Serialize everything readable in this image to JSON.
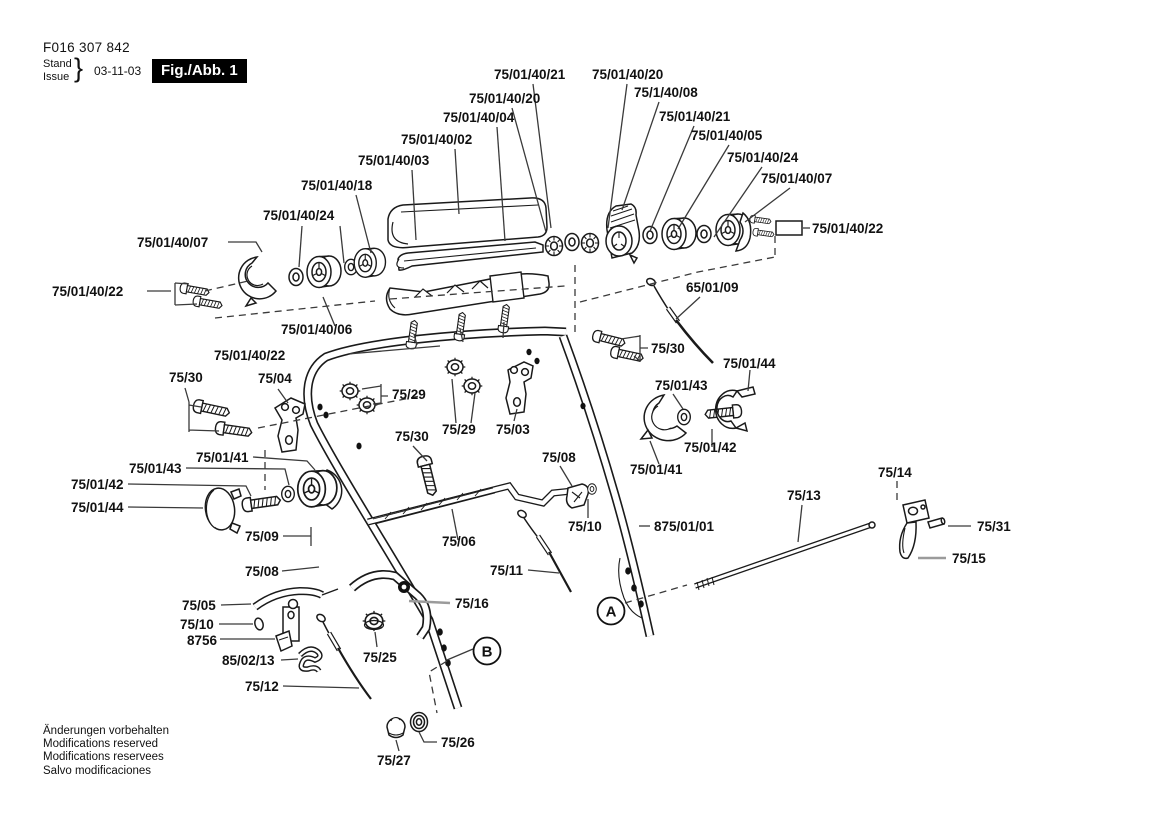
{
  "header": {
    "doc_number": "F016 307 842",
    "stand_label": "Stand",
    "issue_label": "Issue",
    "brace": "}",
    "date": "03-11-03",
    "figure_badge": "Fig./Abb. 1"
  },
  "footer": {
    "line1": "Änderungen vorbehalten",
    "line2": "Modifications reserved",
    "line3": "Modifications reservees",
    "line4": "Salvo modificaciones"
  },
  "diagram": {
    "callouts": {
      "a": "A",
      "b": "B"
    },
    "labels": [
      {
        "text": "75/01/40/21",
        "x": 494,
        "y": 79
      },
      {
        "text": "75/01/40/20",
        "x": 592,
        "y": 79
      },
      {
        "text": "75/01/40/20",
        "x": 469,
        "y": 103
      },
      {
        "text": "75/1/40/08",
        "x": 634,
        "y": 97
      },
      {
        "text": "75/01/40/04",
        "x": 443,
        "y": 122
      },
      {
        "text": "75/01/40/21",
        "x": 659,
        "y": 121
      },
      {
        "text": "75/01/40/02",
        "x": 401,
        "y": 144
      },
      {
        "text": "75/01/40/05",
        "x": 691,
        "y": 140
      },
      {
        "text": "75/01/40/03",
        "x": 358,
        "y": 165
      },
      {
        "text": "75/01/40/24",
        "x": 727,
        "y": 162
      },
      {
        "text": "75/01/40/18",
        "x": 301,
        "y": 190
      },
      {
        "text": "75/01/40/07",
        "x": 761,
        "y": 183
      },
      {
        "text": "75/01/40/24",
        "x": 263,
        "y": 220
      },
      {
        "text": "75/01/40/22",
        "x": 812,
        "y": 233
      },
      {
        "text": "75/01/40/07",
        "x": 137,
        "y": 247
      },
      {
        "text": "75/01/40/22",
        "x": 52,
        "y": 296
      },
      {
        "text": "65/01/09",
        "x": 686,
        "y": 292
      },
      {
        "text": "75/01/40/06",
        "x": 281,
        "y": 334
      },
      {
        "text": "75/01/40/22",
        "x": 214,
        "y": 360
      },
      {
        "text": "75/30",
        "x": 651,
        "y": 353
      },
      {
        "text": "75/01/44",
        "x": 723,
        "y": 368
      },
      {
        "text": "75/30",
        "x": 169,
        "y": 382
      },
      {
        "text": "75/04",
        "x": 258,
        "y": 383
      },
      {
        "text": "75/29",
        "x": 392,
        "y": 399
      },
      {
        "text": "75/01/43",
        "x": 655,
        "y": 390
      },
      {
        "text": "75/29",
        "x": 442,
        "y": 434
      },
      {
        "text": "75/03",
        "x": 496,
        "y": 434
      },
      {
        "text": "75/30",
        "x": 395,
        "y": 441
      },
      {
        "text": "75/08",
        "x": 542,
        "y": 462
      },
      {
        "text": "75/01/41",
        "x": 196,
        "y": 462
      },
      {
        "text": "75/01/43",
        "x": 129,
        "y": 473
      },
      {
        "text": "75/01/42",
        "x": 71,
        "y": 489
      },
      {
        "text": "75/14",
        "x": 878,
        "y": 477
      },
      {
        "text": "75/01/41",
        "x": 630,
        "y": 474
      },
      {
        "text": "75/01/42",
        "x": 684,
        "y": 452
      },
      {
        "text": "75/01/44",
        "x": 71,
        "y": 512
      },
      {
        "text": "75/13",
        "x": 787,
        "y": 500
      },
      {
        "text": "875/01/01",
        "x": 654,
        "y": 531
      },
      {
        "text": "75/10",
        "x": 568,
        "y": 531
      },
      {
        "text": "75/09",
        "x": 245,
        "y": 541
      },
      {
        "text": "75/06",
        "x": 442,
        "y": 546
      },
      {
        "text": "75/31",
        "x": 977,
        "y": 531
      },
      {
        "text": "75/15",
        "x": 952,
        "y": 563
      },
      {
        "text": "75/08",
        "x": 245,
        "y": 576
      },
      {
        "text": "75/11",
        "x": 490,
        "y": 575
      },
      {
        "text": "75/05",
        "x": 182,
        "y": 610
      },
      {
        "text": "75/10",
        "x": 180,
        "y": 629
      },
      {
        "text": "8756",
        "x": 187,
        "y": 645
      },
      {
        "text": "75/16",
        "x": 455,
        "y": 608
      },
      {
        "text": "85/02/13",
        "x": 222,
        "y": 665
      },
      {
        "text": "75/25",
        "x": 363,
        "y": 662
      },
      {
        "text": "75/12",
        "x": 245,
        "y": 691
      },
      {
        "text": "75/26",
        "x": 441,
        "y": 747
      },
      {
        "text": "75/27",
        "x": 377,
        "y": 765
      }
    ]
  }
}
